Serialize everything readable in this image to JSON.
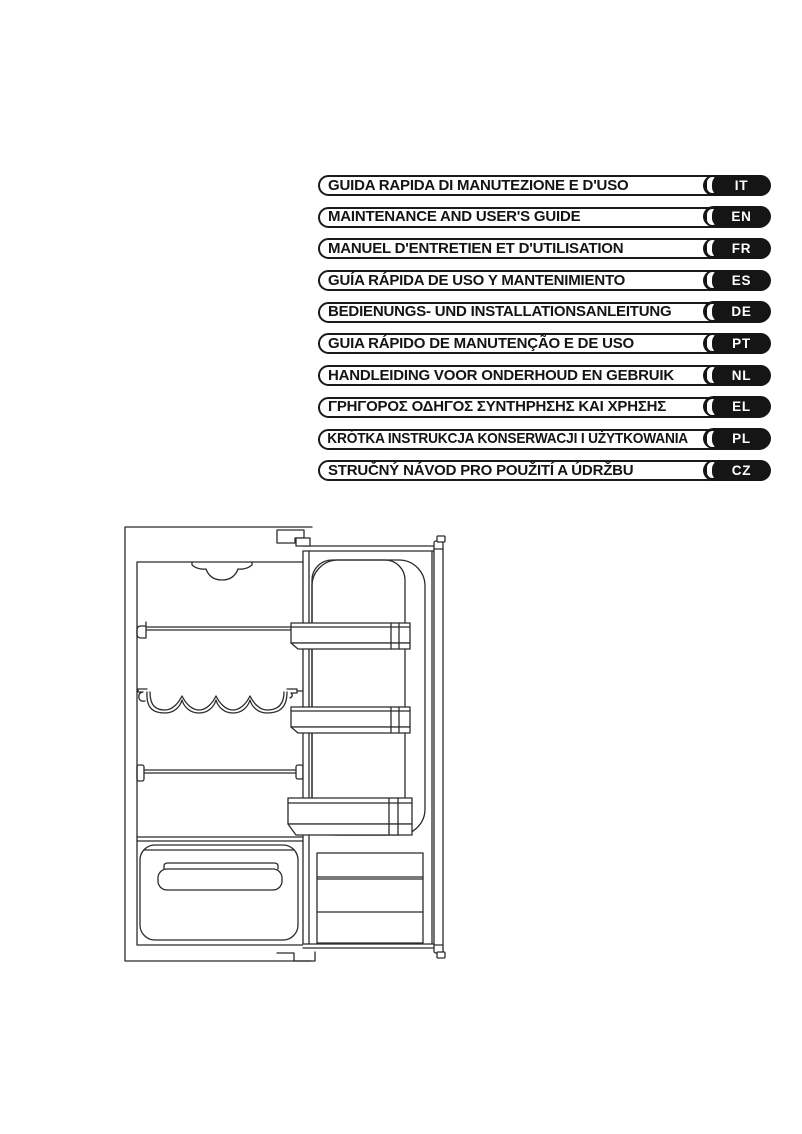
{
  "page": {
    "background": "#ffffff",
    "ink": "#1a1a1a",
    "badge_bg": "#151515",
    "badge_text": "#ffffff"
  },
  "language_index": {
    "items": [
      {
        "title": "GUIDA RAPIDA DI MANUTEZIONE E D'USO",
        "code": "IT"
      },
      {
        "title": "MAINTENANCE AND USER'S GUIDE",
        "code": "EN"
      },
      {
        "title": "MANUEL D'ENTRETIEN ET D'UTILISATION",
        "code": "FR"
      },
      {
        "title": "GUÍA RÁPIDA DE USO Y MANTENIMIENTO",
        "code": "ES"
      },
      {
        "title": "BEDIENUNGS- UND INSTALLATIONSANLEITUNG",
        "code": "DE"
      },
      {
        "title": "GUIA RÁPIDO DE MANUTENÇÃO E DE USO",
        "code": "PT"
      },
      {
        "title": "HANDLEIDING VOOR ONDERHOUD EN GEBRUIK",
        "code": "NL"
      },
      {
        "title": "ΓΡΗΓΟΡΟΣ ΟΔΗΓΟΣ ΣΥΝΤΗΡΗΣΗΣ ΚΑΙ ΧΡΗΣΗΣ",
        "code": "EL"
      },
      {
        "title": "KRÓTKA INSTRUKCJA KONSERWACJI I UŻYTKOWANIA",
        "code": "PL"
      },
      {
        "title": "STRUČNÝ NÁVOD PRO POUŽITÍ A ÚDRŽBU",
        "code": "CZ"
      }
    ]
  },
  "figure": {
    "subject": "Line drawing of a built-in refrigerator interior with open door, shelves, wine rack, crisper drawer and three door bins"
  }
}
